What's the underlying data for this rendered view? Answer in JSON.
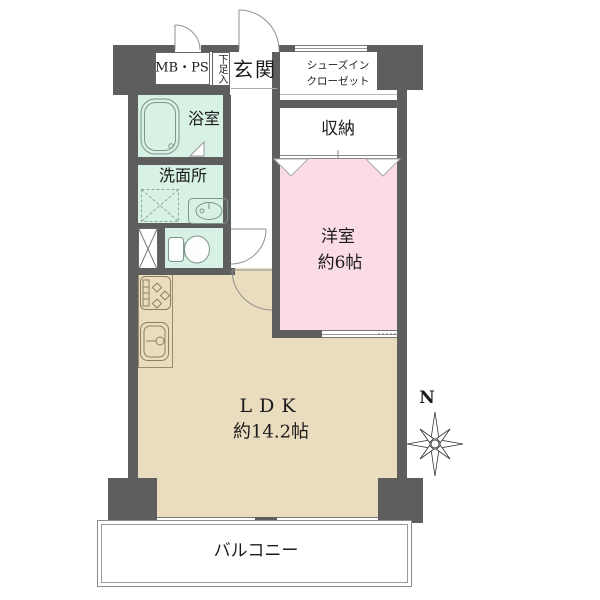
{
  "colors": {
    "wall": "#5e5e5e",
    "wet": "#d8f1e5",
    "bedroom": "#fbdce6",
    "living": "#eadcbe",
    "text": "#1b1b1b"
  },
  "rooms": {
    "mbps": {
      "label": "MB・PS"
    },
    "shoe_cabinet": {
      "label": "下足入"
    },
    "entrance": {
      "label": "玄関"
    },
    "shoes_in_closet": {
      "line1": "シューズイン",
      "line2": "クローゼット"
    },
    "bathroom": {
      "label": "浴室"
    },
    "washroom": {
      "label": "洗面所"
    },
    "storage": {
      "label": "収納"
    },
    "western_room": {
      "label": "洋室",
      "size": "約6帖"
    },
    "ldk": {
      "label": "LDK",
      "size": "約14.2帖"
    },
    "balcony": {
      "label": "バルコニー"
    }
  },
  "compass": {
    "north": "N"
  }
}
